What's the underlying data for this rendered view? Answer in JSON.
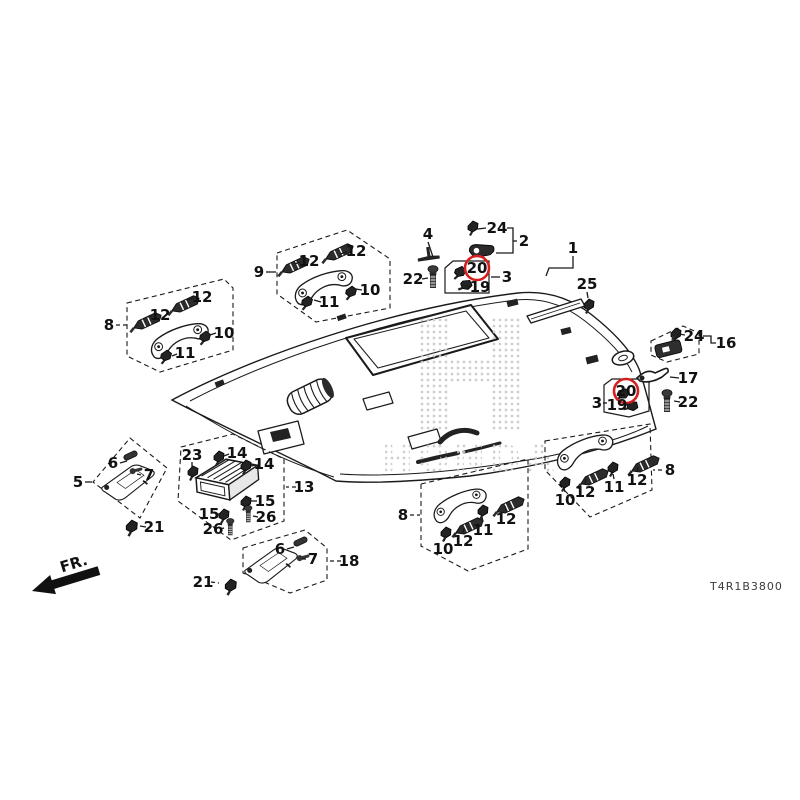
{
  "diagram": {
    "code": "T4R1B3800",
    "fr_label": "FR.",
    "watermark_logo": "H",
    "watermark_text": "HONDA",
    "red_circle_color": "#d42020",
    "line_color": "#1a1a1a"
  },
  "callouts": [
    {
      "text": "4",
      "x": 428,
      "y": 234,
      "leader": [
        428,
        242,
        433,
        257
      ]
    },
    {
      "text": "24",
      "x": 497,
      "y": 228,
      "leader": [
        486,
        228,
        478,
        229
      ],
      "poly": [
        [
          507,
          228
        ],
        [
          513,
          228
        ],
        [
          513,
          253
        ],
        [
          496,
          253
        ]
      ]
    },
    {
      "text": "2",
      "x": 524,
      "y": 241,
      "leader": [
        517,
        241,
        513,
        241
      ]
    },
    {
      "text": "22",
      "x": 413,
      "y": 279,
      "leader": [
        422,
        279,
        428,
        278
      ]
    },
    {
      "text": "20",
      "x": 477,
      "y": 268,
      "circled": true
    },
    {
      "text": "3",
      "x": 507,
      "y": 277,
      "leader": [
        500,
        277,
        491,
        277
      ]
    },
    {
      "text": "19",
      "x": 480,
      "y": 287,
      "leader": [
        471,
        287,
        466,
        286
      ]
    },
    {
      "text": "1",
      "x": 573,
      "y": 248,
      "poly": [
        [
          573,
          256
        ],
        [
          573,
          268
        ],
        [
          549,
          268
        ],
        [
          546,
          276
        ]
      ]
    },
    {
      "text": "25",
      "x": 587,
      "y": 284,
      "leader": [
        587,
        292,
        588,
        298
      ]
    },
    {
      "text": "9",
      "x": 259,
      "y": 272,
      "leader": [
        266,
        272,
        276,
        272
      ]
    },
    {
      "text": "12",
      "x": 309,
      "y": 261,
      "leader": [
        301,
        262,
        294,
        264
      ]
    },
    {
      "text": "12",
      "x": 356,
      "y": 251,
      "leader": [
        347,
        252,
        340,
        254
      ]
    },
    {
      "text": "10",
      "x": 370,
      "y": 290,
      "leader": [
        362,
        290,
        356,
        289
      ]
    },
    {
      "text": "11",
      "x": 329,
      "y": 302,
      "leader": [
        321,
        302,
        314,
        300
      ]
    },
    {
      "text": "8",
      "x": 109,
      "y": 325,
      "leader": [
        116,
        325,
        127,
        325
      ],
      "dash": true
    },
    {
      "text": "12",
      "x": 202,
      "y": 297,
      "leader": [
        194,
        298,
        187,
        300
      ]
    },
    {
      "text": "12",
      "x": 160,
      "y": 315,
      "leader": [
        152,
        316,
        147,
        317
      ]
    },
    {
      "text": "10",
      "x": 224,
      "y": 333,
      "leader": [
        216,
        333,
        210,
        335
      ]
    },
    {
      "text": "11",
      "x": 185,
      "y": 353,
      "leader": [
        177,
        354,
        172,
        356
      ]
    },
    {
      "text": "24",
      "x": 694,
      "y": 336,
      "leader": [
        685,
        335,
        679,
        334
      ],
      "poly": [
        [
          703,
          336
        ],
        [
          711,
          336
        ],
        [
          711,
          343
        ],
        [
          716,
          343
        ]
      ]
    },
    {
      "text": "16",
      "x": 726,
      "y": 343
    },
    {
      "text": "17",
      "x": 688,
      "y": 378,
      "leader": [
        679,
        378,
        670,
        377
      ]
    },
    {
      "text": "3",
      "x": 597,
      "y": 403,
      "leader": [
        603,
        403,
        607,
        403
      ]
    },
    {
      "text": "20",
      "x": 626,
      "y": 391,
      "circled": true
    },
    {
      "text": "19",
      "x": 617,
      "y": 405,
      "leader": [
        625,
        405,
        630,
        404
      ]
    },
    {
      "text": "22",
      "x": 688,
      "y": 402,
      "leader": [
        680,
        402,
        674,
        401
      ]
    },
    {
      "text": "6",
      "x": 113,
      "y": 463,
      "leader": [
        120,
        463,
        127,
        461
      ]
    },
    {
      "text": "7",
      "x": 149,
      "y": 475,
      "leader": [
        141,
        475,
        137,
        474
      ]
    },
    {
      "text": "5",
      "x": 78,
      "y": 482,
      "leader": [
        85,
        482,
        92,
        482
      ]
    },
    {
      "text": "21",
      "x": 154,
      "y": 527,
      "leader": [
        146,
        527,
        140,
        526
      ]
    },
    {
      "text": "23",
      "x": 192,
      "y": 455,
      "leader": [
        192,
        462,
        192,
        467
      ]
    },
    {
      "text": "14",
      "x": 237,
      "y": 453,
      "leader": [
        229,
        454,
        224,
        456
      ]
    },
    {
      "text": "14",
      "x": 264,
      "y": 464,
      "leader": [
        256,
        465,
        251,
        466
      ]
    },
    {
      "text": "13",
      "x": 304,
      "y": 487,
      "leader": [
        296,
        487,
        286,
        487
      ],
      "dash": true
    },
    {
      "text": "15",
      "x": 265,
      "y": 501,
      "leader": [
        257,
        501,
        251,
        501
      ]
    },
    {
      "text": "26",
      "x": 266,
      "y": 517,
      "leader": [
        258,
        517,
        253,
        516
      ]
    },
    {
      "text": "15",
      "x": 209,
      "y": 514,
      "leader": [
        216,
        514,
        220,
        514
      ]
    },
    {
      "text": "26",
      "x": 213,
      "y": 529,
      "leader": [
        220,
        529,
        224,
        528
      ]
    },
    {
      "text": "6",
      "x": 280,
      "y": 549,
      "leader": [
        287,
        549,
        294,
        547
      ]
    },
    {
      "text": "7",
      "x": 313,
      "y": 559,
      "leader": [
        306,
        559,
        302,
        559
      ]
    },
    {
      "text": "18",
      "x": 349,
      "y": 561,
      "leader": [
        341,
        561,
        329,
        561
      ],
      "dash": true
    },
    {
      "text": "21",
      "x": 203,
      "y": 582,
      "leader": [
        211,
        582,
        219,
        583
      ],
      "dash": true
    },
    {
      "text": "8",
      "x": 403,
      "y": 515,
      "leader": [
        410,
        515,
        420,
        515
      ],
      "dash": true
    },
    {
      "text": "10",
      "x": 443,
      "y": 549,
      "leader": [
        444,
        541,
        446,
        536
      ]
    },
    {
      "text": "12",
      "x": 463,
      "y": 541,
      "leader": [
        463,
        533,
        464,
        528
      ]
    },
    {
      "text": "11",
      "x": 483,
      "y": 530,
      "leader": [
        483,
        522,
        482,
        517
      ]
    },
    {
      "text": "12",
      "x": 506,
      "y": 519,
      "leader": [
        506,
        511,
        505,
        506
      ]
    },
    {
      "text": "8",
      "x": 670,
      "y": 470,
      "leader": [
        662,
        470,
        653,
        470
      ],
      "dash": true
    },
    {
      "text": "10",
      "x": 565,
      "y": 500,
      "leader": [
        565,
        492,
        564,
        488
      ]
    },
    {
      "text": "12",
      "x": 585,
      "y": 492,
      "leader": [
        585,
        484,
        586,
        479
      ]
    },
    {
      "text": "11",
      "x": 614,
      "y": 487,
      "leader": [
        614,
        479,
        613,
        474
      ]
    },
    {
      "text": "12",
      "x": 637,
      "y": 480,
      "leader": [
        637,
        472,
        638,
        467
      ]
    }
  ]
}
